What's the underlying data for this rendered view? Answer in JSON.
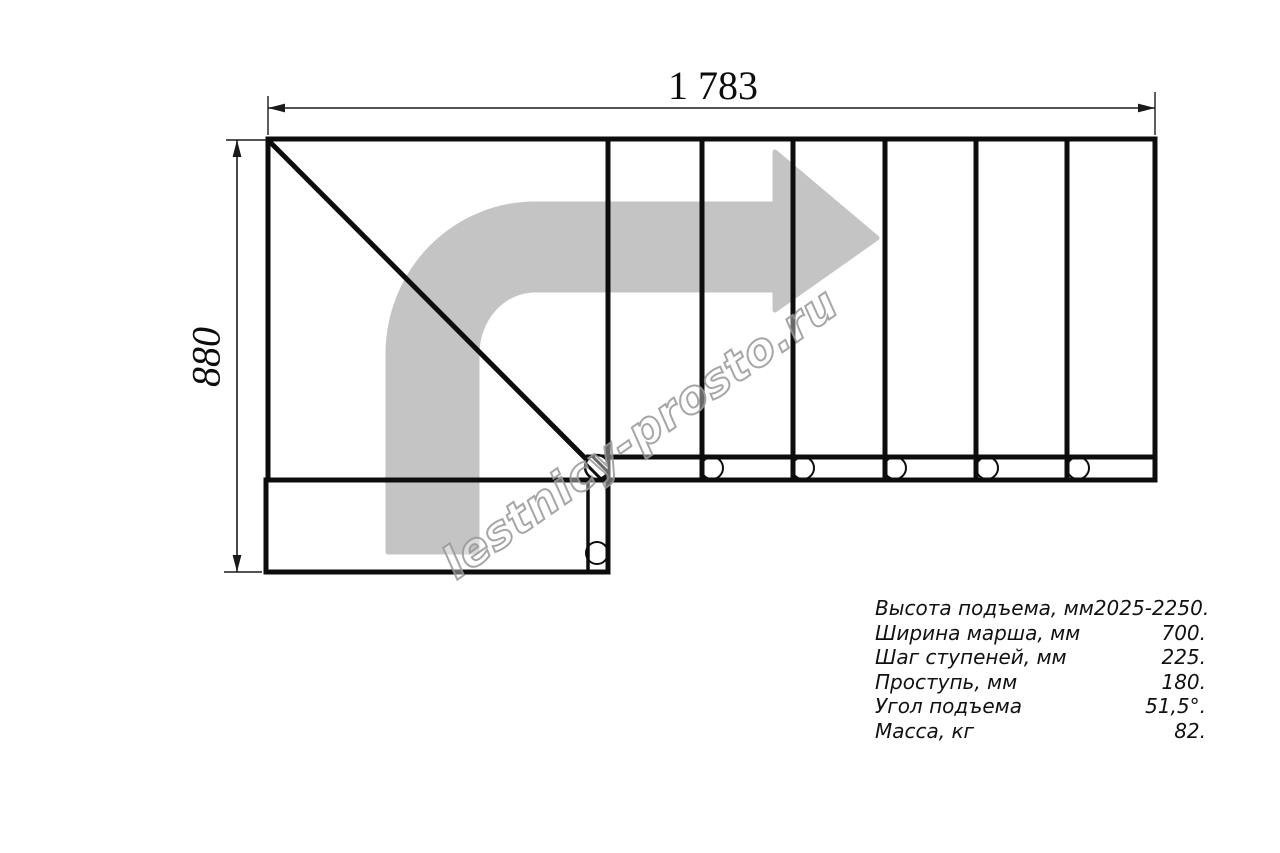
{
  "drawing": {
    "title": "staircase-plan-top-view",
    "width_dimension": "1 783",
    "depth_dimension": "880",
    "direction_arrow": "turn-right-arrow",
    "step_count_straight_flight": 6,
    "colors": {
      "line": "#0d0d0d",
      "arrow_fill": "#c4c4c4",
      "background": "#ffffff",
      "watermark_outline": "#969696"
    }
  },
  "watermark": {
    "text": "lestnicy-prosto.ru"
  },
  "specs": {
    "rows": [
      {
        "label": "Высота подъема, мм",
        "value": "2025-2250."
      },
      {
        "label": "Ширина марша, мм",
        "value": "700."
      },
      {
        "label": "Шаг ступеней, мм",
        "value": "225."
      },
      {
        "label": "Проступь, мм",
        "value": "180."
      },
      {
        "label": "Угол подъема",
        "value": "51,5°."
      },
      {
        "label": "Масса, кг",
        "value": "82."
      }
    ]
  }
}
